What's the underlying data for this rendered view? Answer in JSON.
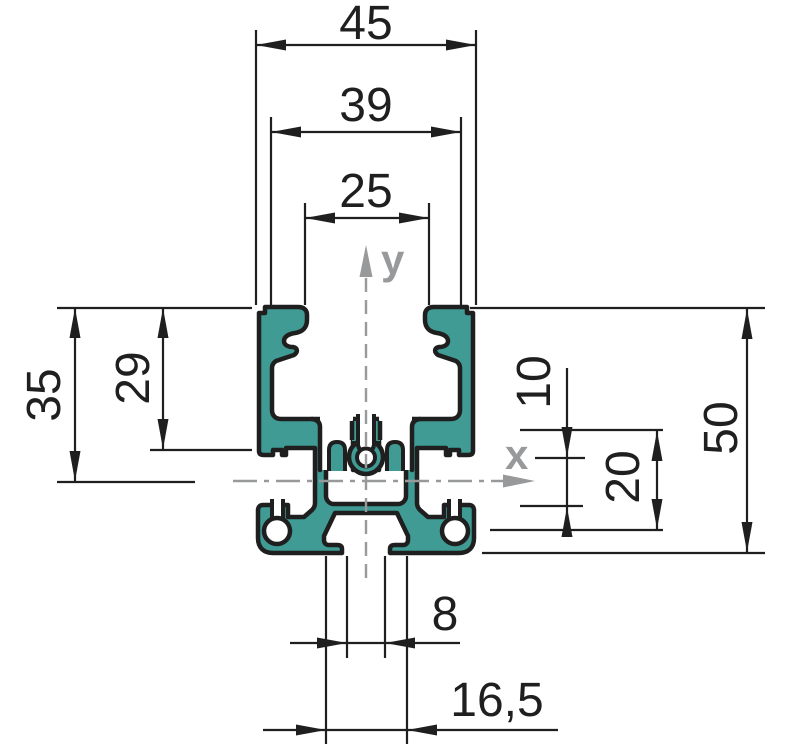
{
  "drawing": {
    "type": "profile-cross-section-technical-drawing",
    "dimensions": {
      "overall_width": "45",
      "channel_inner_width": "39",
      "channel_mouth_width": "25",
      "height_above_axis": "35",
      "channel_depth": "29",
      "overall_height": "50",
      "side_slot_height": "10",
      "core_height": "20",
      "bottom_slot_width": "8",
      "bottom_cavity_width": "16,5"
    },
    "axis_labels": {
      "x": "x",
      "y": "y"
    },
    "colors": {
      "profile_fill": "#3F9B94",
      "outline": "#1f1f1f",
      "dimension_lines": "#1f1f1f",
      "axis_gray": "#97999b",
      "background": "#ffffff"
    }
  }
}
